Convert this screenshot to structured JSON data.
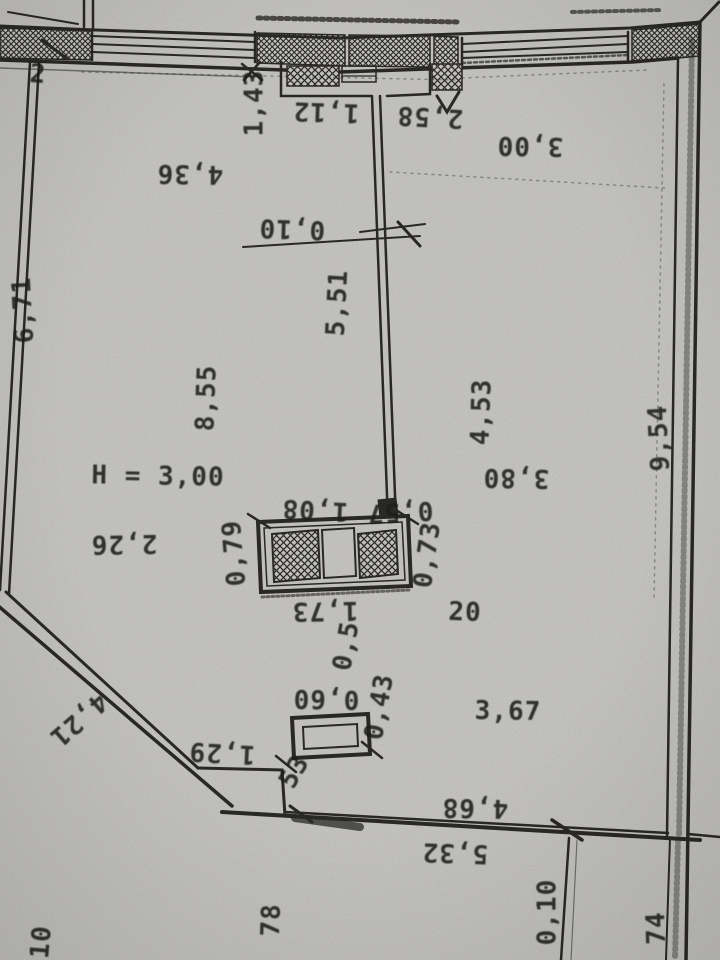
{
  "document": {
    "kind": "floor-plan-photo",
    "room_number": "20",
    "ceiling_height_note": "H = 3,00"
  },
  "colors": {
    "paper": "#d6d5d1",
    "ink": "#2e2d2b",
    "ink_text": "#22211f"
  },
  "labels": [
    {
      "id": "edge-note",
      "text": "2"
    },
    {
      "id": "niche-left-dim",
      "text": "1,43"
    },
    {
      "id": "niche-width-dim",
      "text": "1,12"
    },
    {
      "id": "niche-right-dim",
      "text": "2,58"
    },
    {
      "id": "room-a-width-dim",
      "text": "4,36"
    },
    {
      "id": "room-b-width-dim",
      "text": "3,00"
    },
    {
      "id": "partition-offset-dim",
      "text": "0,10"
    },
    {
      "id": "partition-length-dim",
      "text": "5,51"
    },
    {
      "id": "left-wall-dim",
      "text": "6,71"
    },
    {
      "id": "room-a-depth-dim",
      "text": "8,55"
    },
    {
      "id": "ceiling-height-note",
      "text": "H = 3,00"
    },
    {
      "id": "room-b-depth-dim",
      "text": "4,53"
    },
    {
      "id": "room-b-dim",
      "text": "3,80"
    },
    {
      "id": "room-a-dim",
      "text": "2,26"
    },
    {
      "id": "shaft-top-left-dim",
      "text": "1,08"
    },
    {
      "id": "shaft-top-right-dim",
      "text": "0,57"
    },
    {
      "id": "shaft-left-dim",
      "text": "0,79"
    },
    {
      "id": "shaft-right-dim",
      "text": "0,73"
    },
    {
      "id": "shaft-bottom-dim",
      "text": "1,73"
    },
    {
      "id": "room-number",
      "text": "20"
    },
    {
      "id": "gap-dim",
      "text": "0,5"
    },
    {
      "id": "box-width-dim",
      "text": "0,60"
    },
    {
      "id": "box-depth-dim",
      "text": "0,43"
    },
    {
      "id": "room-c-dim",
      "text": "3,67"
    },
    {
      "id": "diagonal-wall-dim",
      "text": "4,21"
    },
    {
      "id": "step-width-dim",
      "text": "1,29"
    },
    {
      "id": "step-depth-dim",
      "text": "53"
    },
    {
      "id": "bottom-wall-upper-dim",
      "text": "4,68"
    },
    {
      "id": "bottom-wall-lower-dim",
      "text": "5,32"
    },
    {
      "id": "right-wall-dim",
      "text": "9,54"
    },
    {
      "id": "lower-offset-dim",
      "text": "0,10"
    },
    {
      "id": "lower-right-dim",
      "text": "74"
    },
    {
      "id": "lower-mid-dim",
      "text": "78"
    },
    {
      "id": "lower-left-dim",
      "text": "10"
    }
  ]
}
